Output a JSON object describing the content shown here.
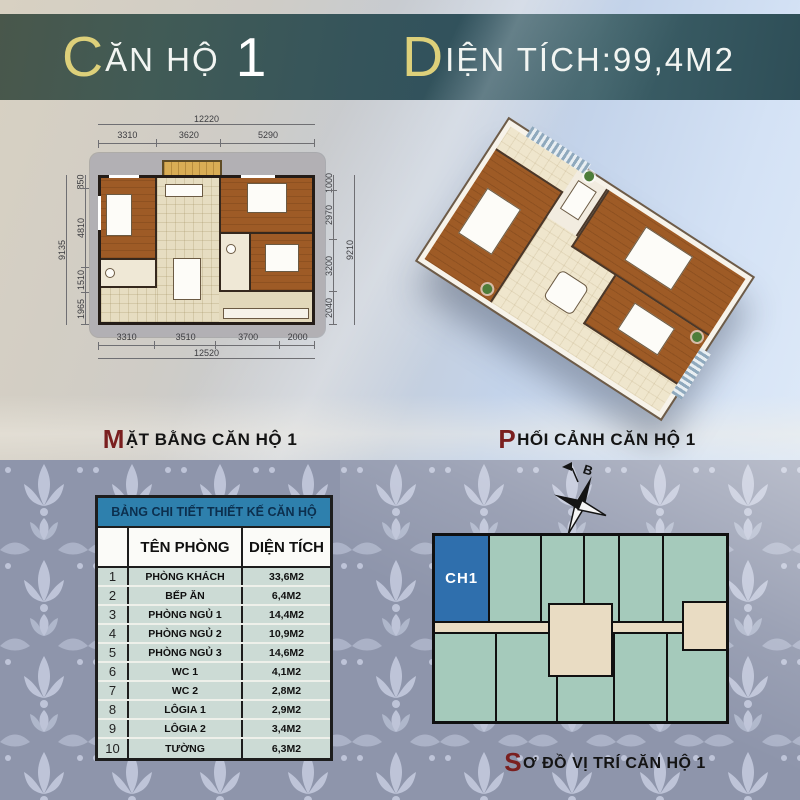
{
  "header": {
    "title_initial": "C",
    "title_rest": "ĂN HỘ",
    "title_number": "1",
    "area_initial": "D",
    "area_rest": "IỆN TÍCH:99,4M2"
  },
  "floorplan_2d": {
    "caption_initial": "M",
    "caption_rest": "ẶT BẰNG CĂN HỘ 1",
    "dims": {
      "top_total": "12220",
      "top_segments": [
        "3310",
        "3620",
        "5290"
      ],
      "bottom_segments": [
        "3310",
        "3510",
        "3700",
        "2000"
      ],
      "bottom_total": "12520",
      "left_total": "9135",
      "left_segments": [
        "850",
        "4810",
        "1510",
        "1965"
      ],
      "right_total": "9210",
      "right_segments": [
        "1000",
        "2970",
        "3200",
        "2040"
      ]
    }
  },
  "floorplan_3d": {
    "caption_initial": "P",
    "caption_rest": "HỐI CẢNH CĂN HỘ 1"
  },
  "key_plan": {
    "caption_initial": "S",
    "caption_rest": "Ơ ĐỒ VỊ TRÍ CĂN HỘ 1",
    "unit_label": "CH1",
    "compass_label": "B"
  },
  "table": {
    "title": "BẢNG CHI TIẾT THIẾT KẾ CĂN HỘ",
    "columns": [
      "TÊN PHÒNG",
      "DIỆN TÍCH"
    ],
    "rows": [
      {
        "no": "1",
        "name": "PHÒNG KHÁCH",
        "area": "33,6M2"
      },
      {
        "no": "2",
        "name": "BẾP ĂN",
        "area": "6,4M2"
      },
      {
        "no": "3",
        "name": "PHÒNG NGỦ 1",
        "area": "14,4M2"
      },
      {
        "no": "4",
        "name": "PHÒNG NGỦ 2",
        "area": "10,9M2"
      },
      {
        "no": "5",
        "name": "PHÒNG NGỦ 3",
        "area": "14,6M2"
      },
      {
        "no": "6",
        "name": "WC 1",
        "area": "4,1M2"
      },
      {
        "no": "7",
        "name": "WC 2",
        "area": "2,8M2"
      },
      {
        "no": "8",
        "name": "LÔGIA 1",
        "area": "2,9M2"
      },
      {
        "no": "9",
        "name": "LÔGIA 2",
        "area": "3,4M2"
      },
      {
        "no": "10",
        "name": "TƯỜNG",
        "area": "6,3M2"
      }
    ]
  },
  "colors": {
    "accent_gold": "#ddd07a",
    "accent_maroon": "#7a1f1f",
    "header_teal": "#35545b",
    "table_header_blue": "#2e80ad",
    "unit_highlight_blue": "#2f6fad",
    "unit_green": "#a5cabb",
    "corridor_beige": "#e9dcc3",
    "damask_base": "#8e95ab",
    "damask_motif": "#c7cde1"
  }
}
